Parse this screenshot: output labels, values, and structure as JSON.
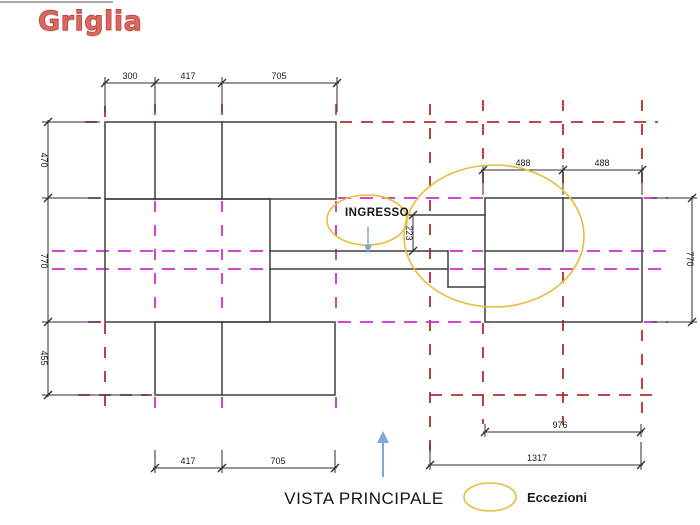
{
  "slide": {
    "title": "Griglia",
    "title_color": "#d9695f"
  },
  "drawing": {
    "labels": {
      "ingresso": "INGRESSO",
      "vista_principale": "VISTA PRINCIPALE"
    },
    "legend": {
      "eccezioni": "Eccezioni"
    },
    "colors": {
      "grid_red": "#b22e2e",
      "grid_magenta": "#cc2fcc",
      "wall_black": "#3f3f3f",
      "dimension_black": "#2e2e2e",
      "highlight_yellow": "#e6be3a",
      "arrow_blue": "#7fa8d9"
    },
    "dimensions": {
      "top": [
        "300",
        "417",
        "705"
      ],
      "left": [
        "470",
        "770",
        "455"
      ],
      "right_top": [
        "488",
        "488"
      ],
      "entry": "223",
      "right_side": "770",
      "bottom_right_inner": "976",
      "bottom_right_outer": "1317",
      "bottom_left": [
        "417",
        "705"
      ]
    }
  }
}
